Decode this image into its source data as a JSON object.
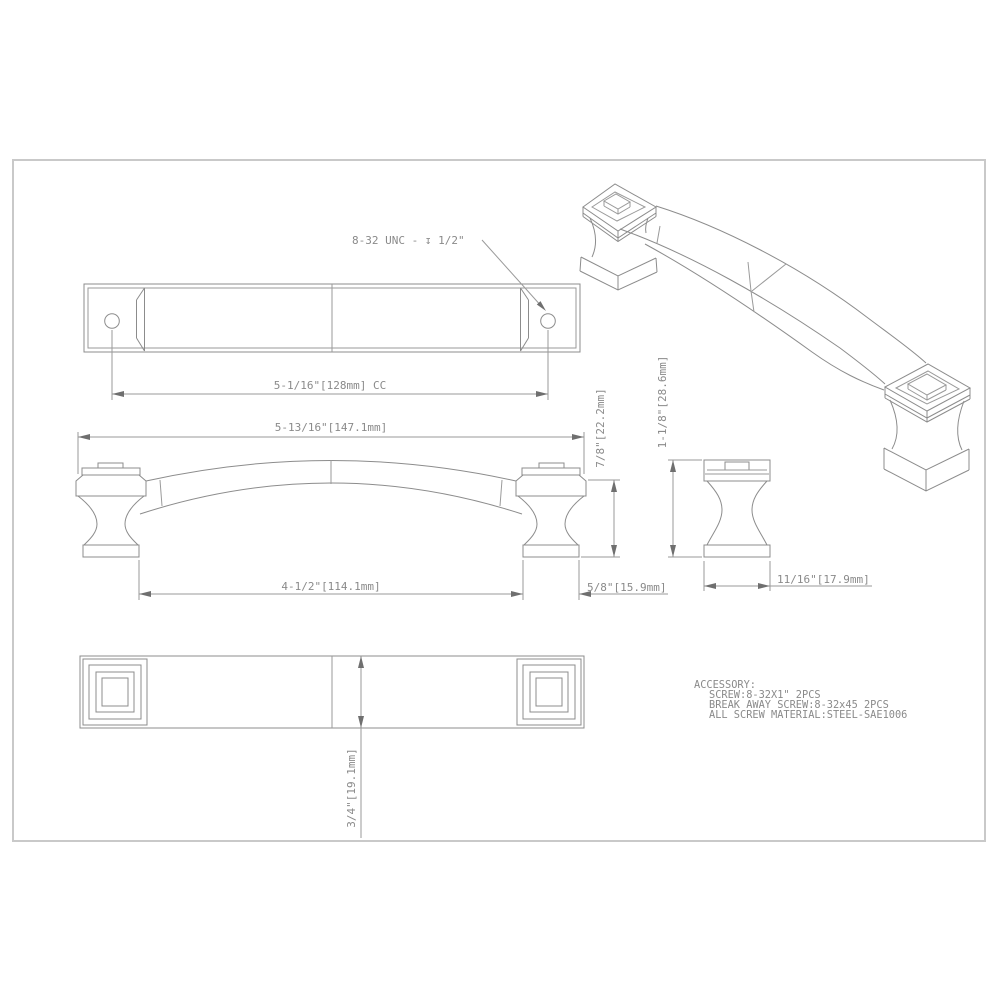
{
  "drawing": {
    "callouts": {
      "thread": "8-32 UNC - ↧ 1/2\""
    },
    "dimensions": {
      "cc": "5-1/16\"[128mm] CC",
      "overall_length": "5-13/16\"[147.1mm]",
      "bar_height": "7/8\"[22.2mm]",
      "foot_height": "1-1/8\"[28.6mm]",
      "inner_span": "4-1/2\"[114.1mm]",
      "foot_base_width": "5/8\"[15.9mm]",
      "side_foot_width": "11/16\"[17.9mm]",
      "bar_width": "3/4\"[19.1mm]"
    },
    "accessory": {
      "title": "ACCESSORY:",
      "line1": "SCREW:8-32X1\" 2PCS",
      "line2": "BREAK AWAY SCREW:8-32x45 2PCS",
      "line3": "ALL SCREW MATERIAL:STEEL-SAE1006"
    },
    "colors": {
      "line": "#8c8c8c",
      "dimension": "#9a9a9a",
      "text": "#8a8a8a",
      "page_border": "#c9c9c9",
      "background": "#ffffff"
    }
  }
}
